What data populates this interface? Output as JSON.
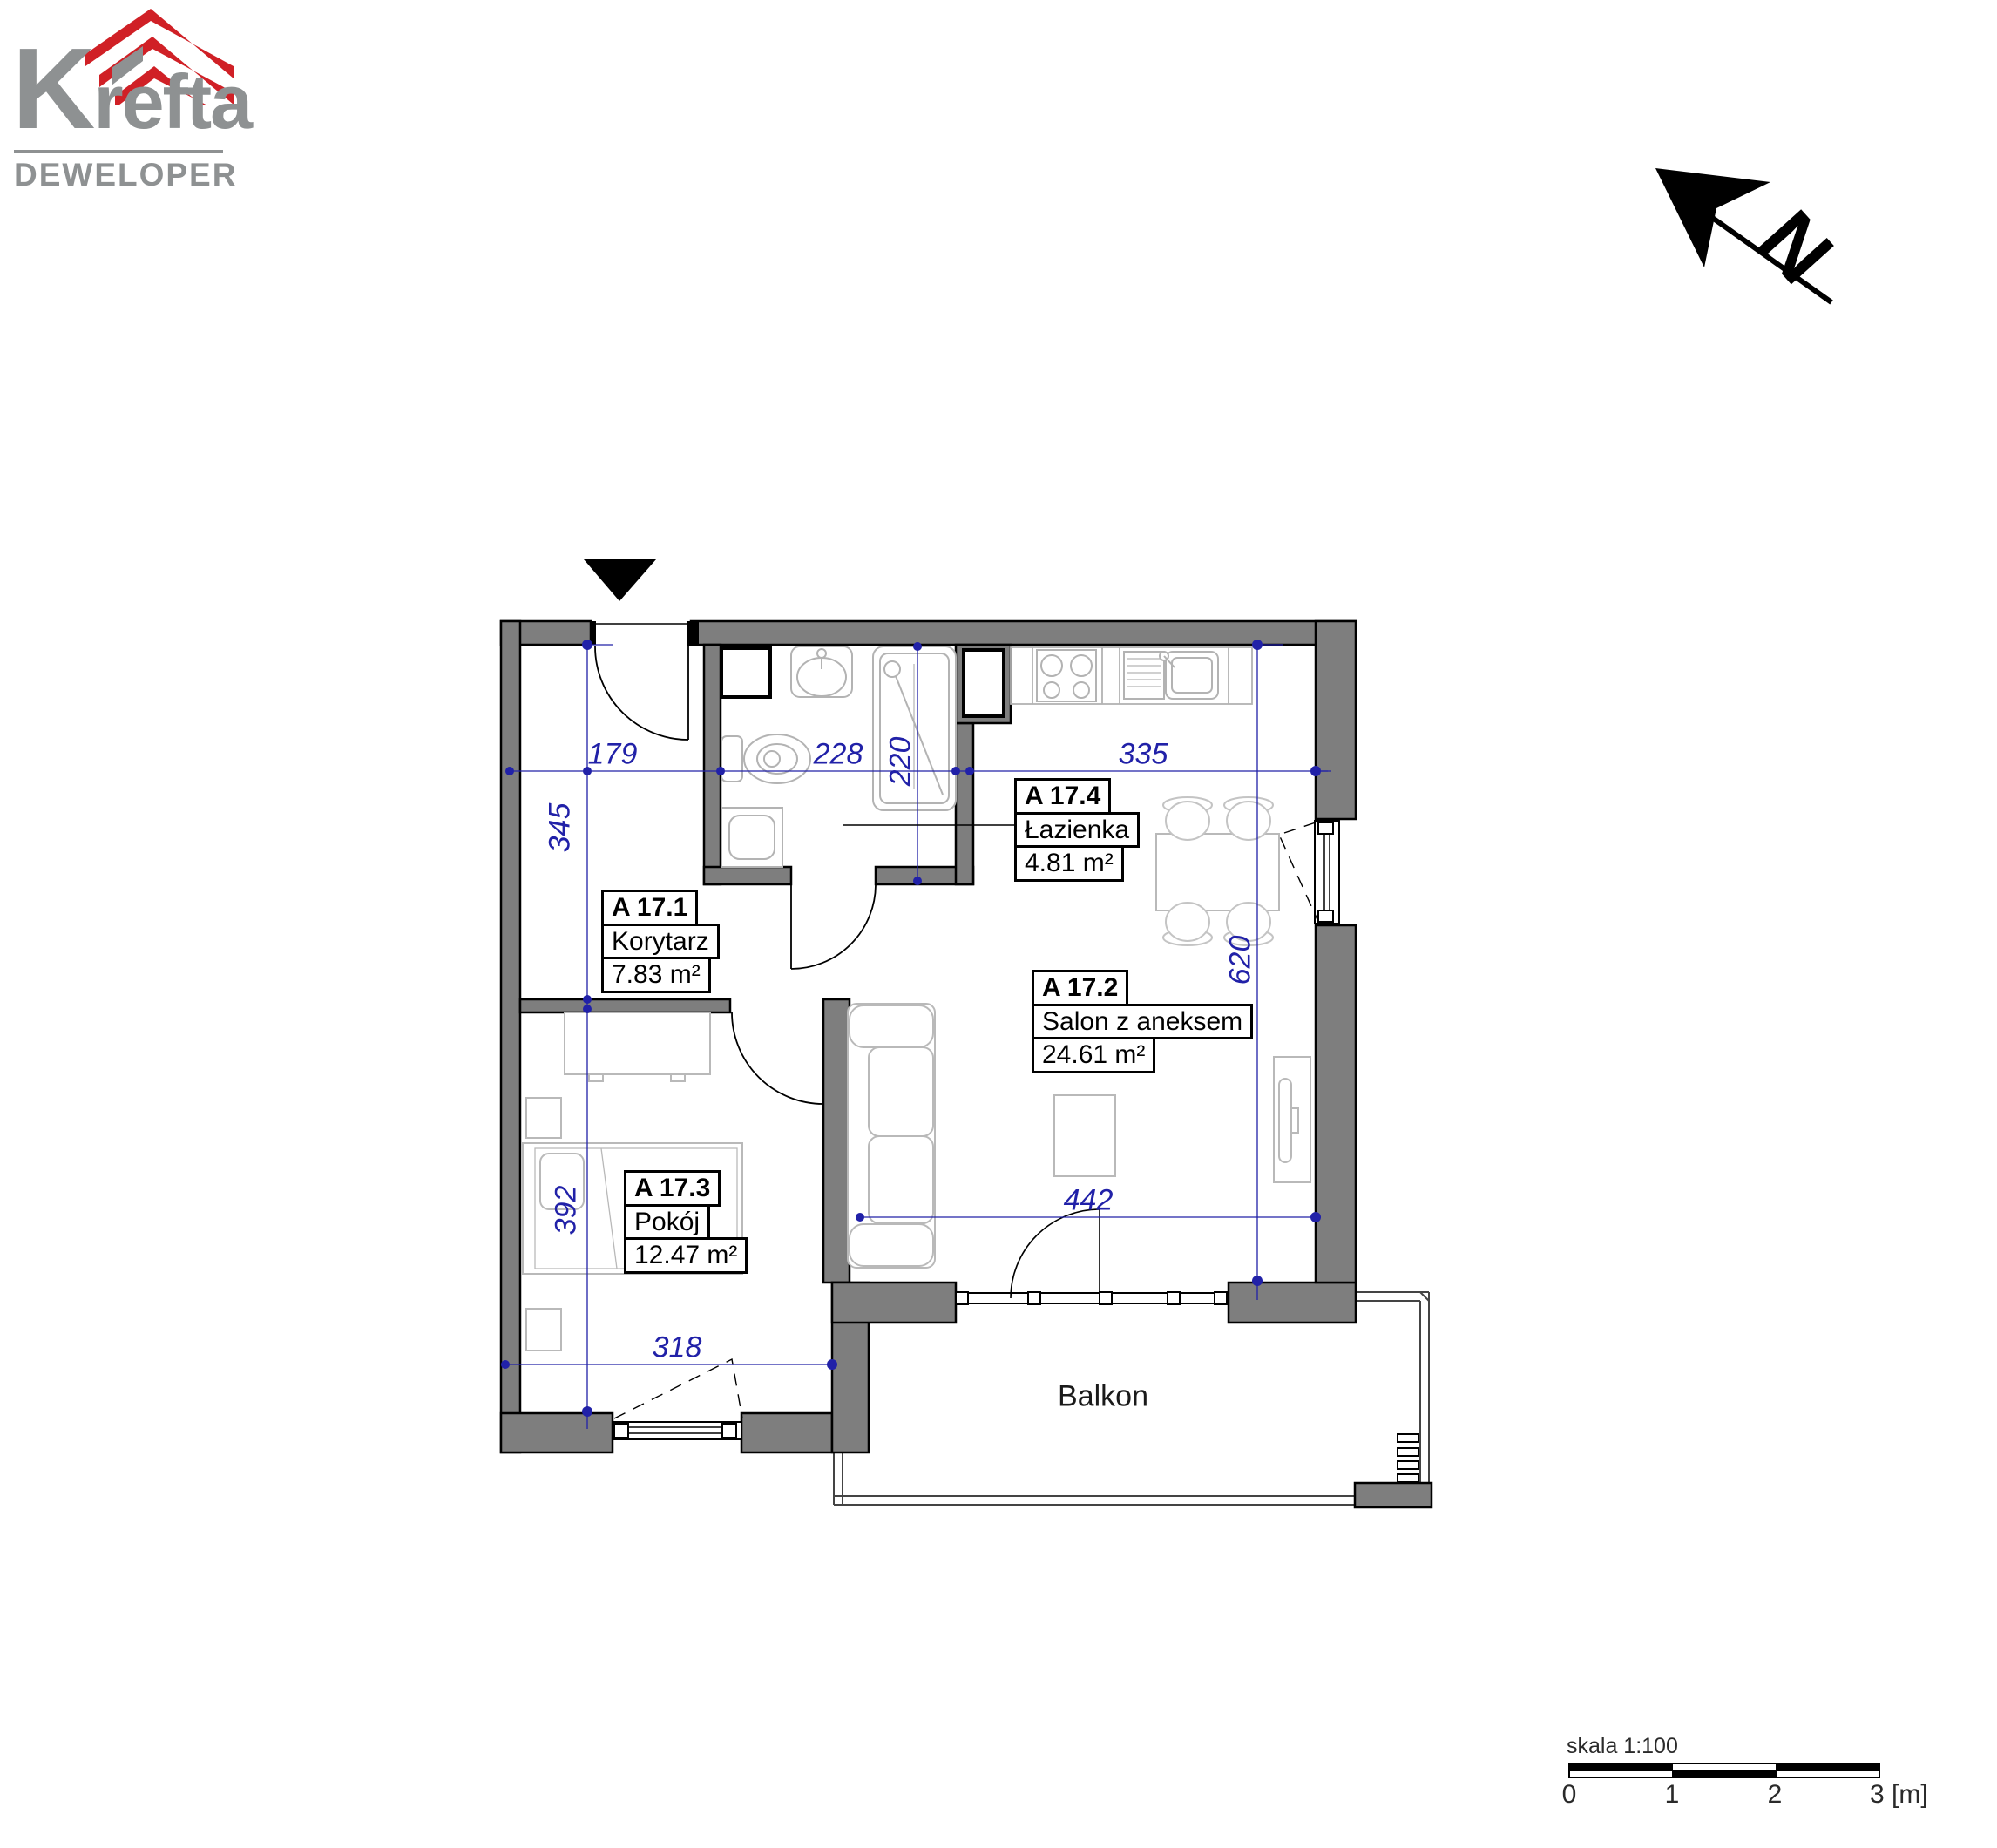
{
  "logo": {
    "brand": "Krefta",
    "tagline": "DEWELOPER"
  },
  "north": {
    "label": "N"
  },
  "icons": {
    "entrance": "entrance-triangle-down",
    "north": "north-arrow-pointing-up-left"
  },
  "rooms": [
    {
      "id": "A 17.1",
      "name": "Korytarz",
      "area": "7.83 m²"
    },
    {
      "id": "A 17.2",
      "name": "Salon z aneksem",
      "area": "24.61 m²"
    },
    {
      "id": "A 17.3",
      "name": "Pokój",
      "area": "12.47 m²"
    },
    {
      "id": "A 17.4",
      "name": "Łazienka",
      "area": "4.81 m²"
    }
  ],
  "balcony_label": "Balkon",
  "dimensions": {
    "hall_width": "179",
    "bath_width": "228",
    "bath_depth": "220",
    "kitchen_width": "335",
    "hall_depth": "345",
    "salon_depth": "620",
    "bedroom_depth": "392",
    "salon_width": "442",
    "bedroom_width": "318"
  },
  "scalebar": {
    "title": "skala 1:100",
    "ticks": [
      "0",
      "1",
      "2",
      "3 [m]"
    ]
  },
  "colors": {
    "wall_gray": "#7e7e7e",
    "dimension_blue": "#2121a8",
    "brand_red": "#d02026",
    "brand_gray": "#8e9192"
  }
}
